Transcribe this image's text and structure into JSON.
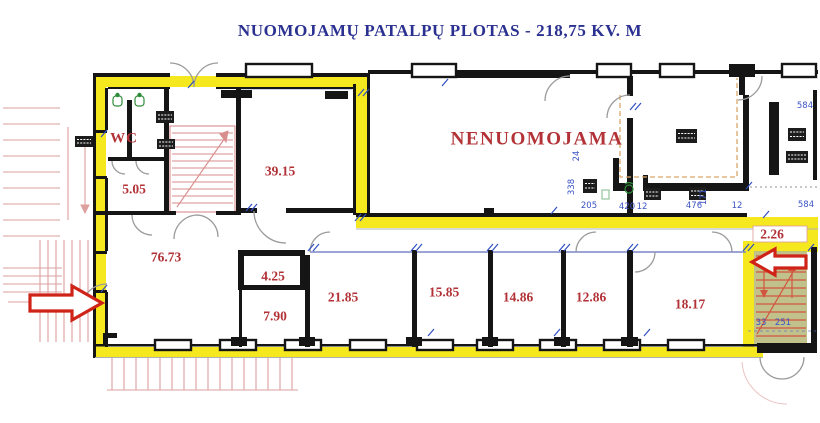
{
  "title": "NUOMOJAMŲ PATALPŲ PLOTAS - 218,75 KV. M",
  "plan": {
    "wc": {
      "label": "WC",
      "x": 124,
      "y": 139
    },
    "non_rentable": {
      "label": "NENUOMOJAMA",
      "x": 537,
      "y": 139
    },
    "rooms": [
      {
        "label": "5.05",
        "x": 134,
        "y": 189
      },
      {
        "label": "39.15",
        "x": 280,
        "y": 171
      },
      {
        "label": "76.73",
        "x": 166,
        "y": 257
      },
      {
        "label": "4.25",
        "x": 273,
        "y": 276
      },
      {
        "label": "7.90",
        "x": 275,
        "y": 316
      },
      {
        "label": "21.85",
        "x": 343,
        "y": 297
      },
      {
        "label": "15.85",
        "x": 444,
        "y": 292
      },
      {
        "label": "14.86",
        "x": 518,
        "y": 297
      },
      {
        "label": "12.86",
        "x": 591,
        "y": 297
      },
      {
        "label": "18.17",
        "x": 690,
        "y": 304
      },
      {
        "label": "2.26",
        "x": 772,
        "y": 234
      }
    ],
    "dimensions": [
      {
        "label": "584",
        "x": 805,
        "y": 106,
        "vertical": false
      },
      {
        "label": "584",
        "x": 806,
        "y": 205,
        "vertical": false
      },
      {
        "label": "24",
        "x": 577,
        "y": 156,
        "vertical": true
      },
      {
        "label": "338",
        "x": 572,
        "y": 187,
        "vertical": true
      },
      {
        "label": "205",
        "x": 589,
        "y": 206,
        "vertical": false
      },
      {
        "label": "420",
        "x": 627,
        "y": 207,
        "vertical": false
      },
      {
        "label": "12",
        "x": 642,
        "y": 207,
        "vertical": false
      },
      {
        "label": "476",
        "x": 694,
        "y": 206,
        "vertical": false
      },
      {
        "label": "171",
        "x": 704,
        "y": 197,
        "vertical": true
      },
      {
        "label": "12",
        "x": 737,
        "y": 206,
        "vertical": false
      },
      {
        "label": "33",
        "x": 761,
        "y": 323,
        "vertical": false
      },
      {
        "label": "251",
        "x": 783,
        "y": 323,
        "vertical": false
      }
    ]
  },
  "colors": {
    "highlight": "#f6e81f",
    "wall": "#151515",
    "room_label": "#b23237",
    "title": "#2b3190",
    "dimension": "#3a53c4",
    "stairs": "#d98e8e",
    "stairwell_fill": "#b9ba7e",
    "arrow": "#cf2318",
    "dashed": "#d8a869",
    "partition": "#7b86c8",
    "fixture": "#2e8b3a",
    "door_arc": "#9b9b9b"
  }
}
